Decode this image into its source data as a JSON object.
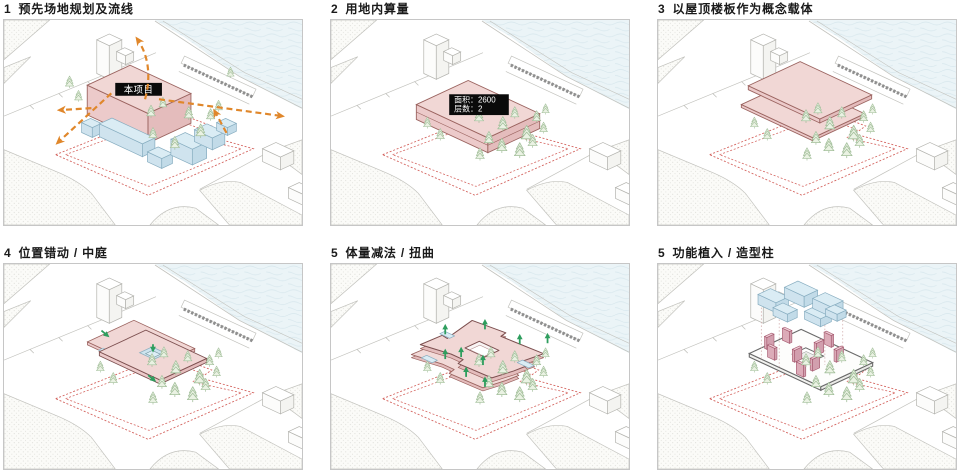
{
  "page": {
    "background": "#ffffff",
    "panel_border": "#c6c6c6"
  },
  "colors": {
    "pink_top": "#f1d7d5",
    "pink_left": "#eccaca",
    "pink_right": "#e4bcbc",
    "pink_stroke": "#9b6460",
    "pink_dark_stroke": "#7c4f4f",
    "blue_top": "#daecf4",
    "blue_left": "#cfe3ee",
    "blue_right": "#c2dbe8",
    "blue_stroke": "#87adc0",
    "water": "#ebf4f7",
    "wave": "#d6e6ec",
    "ground_line": "#c2c2bd",
    "stipple_dot": "#c9c9c3",
    "boundary_red": "#d4645f",
    "flow_orange": "#e0872b",
    "arrow_green": "#2e9e5e",
    "tree_stroke": "#a3bf9b",
    "tree_fill": "#eaf2e3",
    "crosswalk_dark": "#8f8f8f",
    "wireframe": "#6a6a6a",
    "column_top": "#edccd4",
    "column_side": "#dcabb8",
    "column_side2": "#d29fae",
    "column_stroke": "#a4586e",
    "projection_dotted": "#cfa9a9",
    "building_outline": "#b3b3ae",
    "label_bg": "#0a0a0a",
    "label_text": "#ffffff",
    "title_text": "#1a1a1a"
  },
  "panels": [
    {
      "number": "1",
      "title": "预先场地规划及流线",
      "building_label": "本项目"
    },
    {
      "number": "2",
      "title": "用地内算量",
      "area_label": "面积：2600",
      "floors_label": "层数：2"
    },
    {
      "number": "3",
      "title": "以屋顶楼板作为概念载体"
    },
    {
      "number": "4",
      "title": "位置错动 / 中庭"
    },
    {
      "number": "5",
      "title": "体量减法 / 扭曲"
    },
    {
      "number": "5",
      "title": "功能植入 / 造型柱"
    }
  ]
}
